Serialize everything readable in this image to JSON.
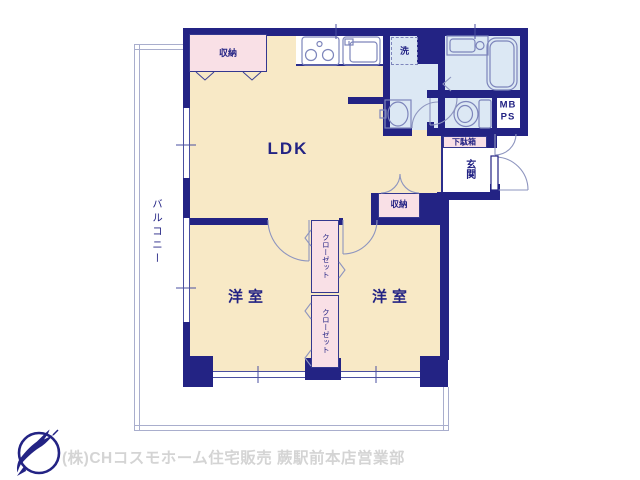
{
  "floorplan": {
    "labels": {
      "ldk": "LDK",
      "bedroom_left": "洋室",
      "bedroom_right": "洋室",
      "balcony": "バルコニー",
      "entrance": "玄関",
      "shoe_cabinet": "下駄箱",
      "storage_top": "収納",
      "storage_center": "収納",
      "closet_upper": "クローゼット",
      "closet_lower": "クローゼット",
      "laundry": "洗",
      "meter_box": "MB",
      "pipe_space": "PS"
    },
    "colors": {
      "wall_navy": "#232384",
      "room_cream": "#f8e9c6",
      "storage_pink": "#f9e0e6",
      "wet_blue": "#dce8f4",
      "fixture_line": "#7d85bb",
      "door_arc": "#8e95bf",
      "window_line": "#4a4fa0",
      "balcony_line": "#a9aecd",
      "footer_text": "#d4d4d4",
      "logo_navy": "#232384"
    }
  },
  "footer": {
    "company_text": "(株)CHコスモホーム住宅販売 蕨駅前本店営業部"
  }
}
